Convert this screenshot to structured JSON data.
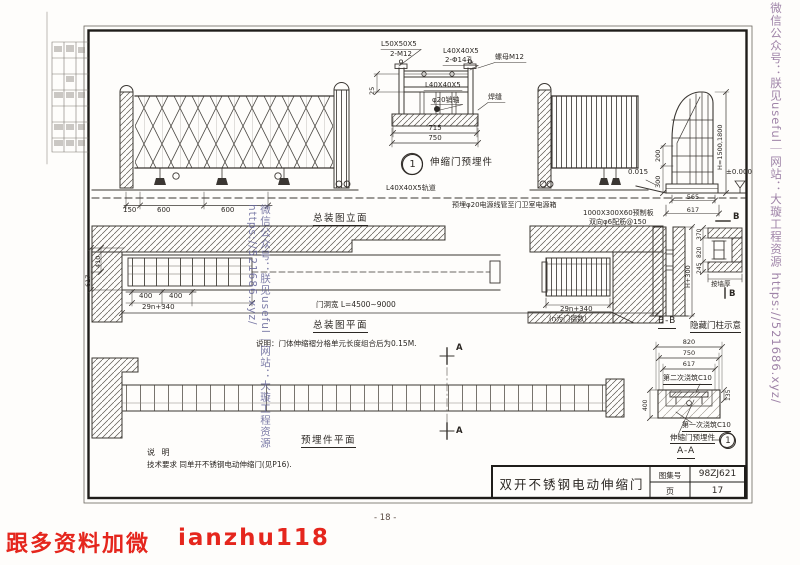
{
  "watermarks": {
    "left_vertical": "微信公众号：朕见useful｜网站：大璇工程资源 https://521686.xyz/",
    "right_vertical": "微信公众号：朕见useful｜网站：大璇工程资源 https://521686.xyz/",
    "promo_red": "跟多资料加微",
    "promo_handle": "ianzhu118"
  },
  "footer": {
    "page_number": "- 18 -"
  },
  "title_block": {
    "drawing_title": "双开不锈钢电动伸缩门",
    "atlas_label": "图集号",
    "atlas_no": "98ZJ621",
    "page_label": "页",
    "page_no": "17"
  },
  "detail_embed": {
    "callout_no": "1",
    "callout_label": "伸缩门预埋件",
    "angle_top_left": "L50X50X5",
    "bolt_top_left": "2-M12",
    "angle_top_right": "L40X40X5",
    "holes_top_right": "2-Φ14孔",
    "nut": "螺母M12",
    "angle_mid": "L40X40X5",
    "pin": "φ20销轴",
    "weld": "焊缝",
    "dim_25": "25",
    "dim_715": "715",
    "dim_750": "750"
  },
  "elevation": {
    "caption": "总装图立面",
    "dim_150": "150",
    "dim_600a": "600",
    "dim_600b": "600",
    "track": "L40X40X5轨道",
    "conduit": "预埋φ20电源线管至门卫室电源箱",
    "slab": "1000X300X60预制板",
    "slab_rebar": "双向φ6配筋@150"
  },
  "end_post": {
    "dim_height": "H=1500,1800",
    "level": "±0.000",
    "slope": "0.015",
    "dim_200": "200",
    "dim_300": "300",
    "dim_565": "565",
    "dim_617": "617"
  },
  "plan": {
    "caption": "总装图平面",
    "dim_400a": "400",
    "dim_400b": "400",
    "dim_fold": "29n+340",
    "opening": "门洞宽 L=4500~9000",
    "fold_right": "29n+340",
    "fold_note": "(n为门褶数)",
    "dim_410": "410",
    "dim_617": "617",
    "note": "说明：门体伸缩褶分格单元长度组合后为0.15M.",
    "cut_marker": "A"
  },
  "section_bb": {
    "caption": "B-B",
    "dim_height": "H+300",
    "cut_marker": "B"
  },
  "hidden_post": {
    "caption": "隐藏门柱示意",
    "dim_370": "370",
    "dim_820": "820",
    "dim_245": "245",
    "wall_note": "按墙厚"
  },
  "section_aa": {
    "caption": "A-A",
    "dim_820": "820",
    "dim_750": "750",
    "dim_617": "617",
    "dim_400": "400",
    "dim_135": "135",
    "pour_second": "第二次浇筑C10",
    "pour_first": "第一次浇筑C10",
    "embed_label": "伸缩门预埋件",
    "callout_no": "1"
  },
  "embed_plan": {
    "caption": "预埋件平面"
  },
  "notes": {
    "heading": "说 明",
    "tech": "技术要求 同单开不锈钢电动伸缩门(见P16)."
  }
}
